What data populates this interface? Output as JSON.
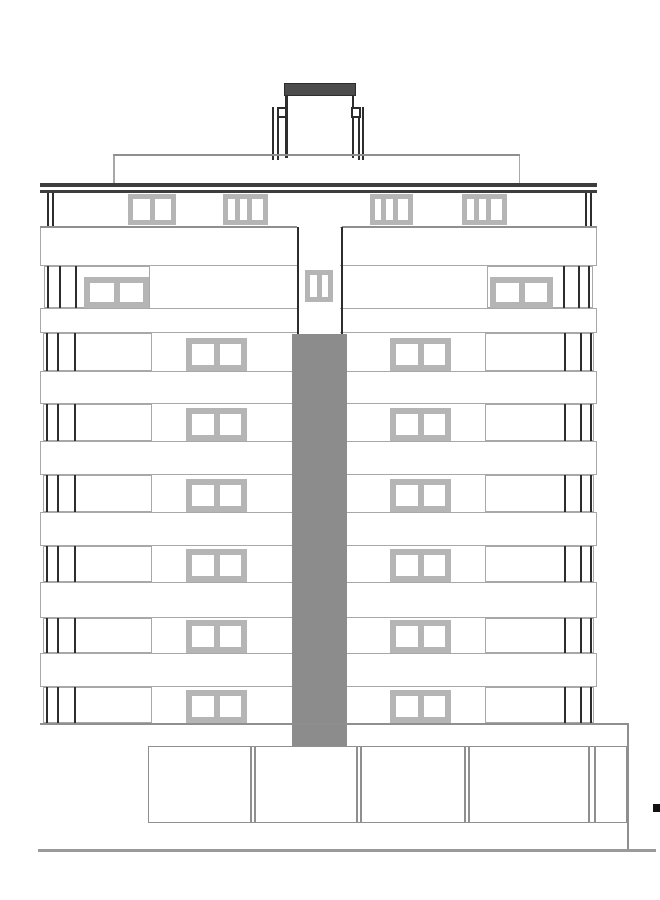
{
  "canvas": {
    "width": 660,
    "height": 900,
    "background": "#ffffff"
  },
  "colors": {
    "white": "#ffffff",
    "black": "#111111",
    "dark": "#2d2d2d",
    "parapet": "#3d3d3d",
    "cap": "#4c4c4c",
    "core": "#8c8c8c",
    "frame": "#b5b5b5",
    "light": "#a8a8a8",
    "mid": "#8f8f8f",
    "ground": "#9a9a9a"
  },
  "rooftop": {
    "items": [
      {
        "type": "rect",
        "name": "stair-tower-cap",
        "x": 284,
        "y": 83,
        "w": 72,
        "h": 13,
        "color": "cap",
        "border": "dark"
      },
      {
        "type": "line",
        "name": "stair-tower-wall-left",
        "x": 285,
        "y": 96,
        "w": 2.5,
        "h": 62,
        "color": "dark"
      },
      {
        "type": "line",
        "name": "stair-tower-wall-right",
        "x": 351.5,
        "y": 96,
        "w": 2.5,
        "h": 62,
        "color": "dark"
      },
      {
        "type": "line",
        "name": "roof-post",
        "x": 272,
        "y": 107,
        "w": 2,
        "h": 53,
        "color": "dark"
      },
      {
        "type": "line",
        "name": "roof-post",
        "x": 276.5,
        "y": 107,
        "w": 2,
        "h": 53,
        "color": "dark"
      },
      {
        "type": "line",
        "name": "roof-post",
        "x": 357.5,
        "y": 107,
        "w": 2,
        "h": 53,
        "color": "dark"
      },
      {
        "type": "line",
        "name": "roof-post",
        "x": 362,
        "y": 107,
        "w": 2,
        "h": 53,
        "color": "dark"
      },
      {
        "type": "box",
        "name": "roof-bracket-left",
        "x": 277,
        "y": 107,
        "w": 10,
        "h": 11,
        "border": "dark",
        "bw": 2
      },
      {
        "type": "box",
        "name": "roof-bracket-right",
        "x": 351,
        "y": 107,
        "w": 10,
        "h": 11,
        "border": "dark",
        "bw": 2
      }
    ]
  },
  "deck": {
    "items": [
      {
        "type": "line",
        "name": "penthouse-roof-line",
        "x": 113,
        "y": 154,
        "w": 407,
        "h": 2,
        "color": "mid"
      },
      {
        "type": "line",
        "name": "penthouse-wall-left",
        "x": 113,
        "y": 156,
        "w": 1.5,
        "h": 27.5,
        "color": "light"
      },
      {
        "type": "line",
        "name": "penthouse-wall-right",
        "x": 518.5,
        "y": 156,
        "w": 1.5,
        "h": 27.5,
        "color": "light"
      }
    ]
  },
  "parapet": {
    "items": [
      {
        "type": "line",
        "name": "parapet-bar-upper",
        "x": 40,
        "y": 183,
        "w": 557,
        "h": 3.5,
        "color": "parapet"
      },
      {
        "type": "line",
        "name": "parapet-bar-lower",
        "x": 40,
        "y": 189.5,
        "w": 557,
        "h": 3.5,
        "color": "parapet"
      }
    ]
  },
  "bands": {
    "x": 40,
    "w": 557,
    "rows": [
      {
        "y": 226.5,
        "h": 39.5
      },
      {
        "y": 308,
        "h": 25
      },
      {
        "y": 371,
        "h": 33
      },
      {
        "y": 441,
        "h": 34
      },
      {
        "y": 512,
        "h": 34
      },
      {
        "y": 582,
        "h": 36
      },
      {
        "y": 653,
        "h": 34
      }
    ]
  },
  "floors": {
    "layout": {
      "regular": {
        "boxes": [
          {
            "x": 43,
            "w": 109
          },
          {
            "x": 485,
            "w": 109
          }
        ],
        "mullions": [
          46,
          57,
          74,
          564,
          580,
          590
        ],
        "windows": [
          {
            "x": 186,
            "w": 61,
            "h": 33,
            "frame": 6,
            "panes": [
              1,
              1
            ]
          },
          {
            "x": 390,
            "w": 61,
            "h": 33,
            "frame": 6,
            "panes": [
              1,
              1
            ]
          }
        ]
      },
      "special": {
        "boxes": [
          {
            "x": 44,
            "w": 106
          },
          {
            "x": 487,
            "w": 106
          }
        ],
        "mullions": [
          47,
          59,
          75,
          563,
          578,
          588
        ],
        "windows": [
          {
            "x": 84,
            "w": 65,
            "h": 31,
            "frame": 6,
            "panes": [
              1,
              1
            ]
          },
          {
            "x": 490,
            "w": 63,
            "h": 31,
            "frame": 6,
            "panes": [
              1,
              1
            ]
          }
        ]
      }
    },
    "rows": [
      {
        "name": "floor-8",
        "kind": "special",
        "y": 266,
        "h": 42
      },
      {
        "name": "floor-7",
        "kind": "regular",
        "y": 333,
        "h": 38
      },
      {
        "name": "floor-6",
        "kind": "regular",
        "y": 404,
        "h": 37
      },
      {
        "name": "floor-5",
        "kind": "regular",
        "y": 475,
        "h": 37
      },
      {
        "name": "floor-4",
        "kind": "regular",
        "y": 546,
        "h": 36
      },
      {
        "name": "floor-3",
        "kind": "regular",
        "y": 618,
        "h": 35
      },
      {
        "name": "floor-2",
        "kind": "regular",
        "y": 687,
        "h": 36
      }
    ]
  },
  "attic": {
    "items": [
      {
        "type": "line",
        "name": "attic-edge-line",
        "x": 47,
        "y": 193,
        "w": 2,
        "h": 33.5,
        "color": "dark"
      },
      {
        "type": "line",
        "name": "attic-edge-line",
        "x": 52,
        "y": 193,
        "w": 2,
        "h": 33.5,
        "color": "dark"
      },
      {
        "type": "line",
        "name": "attic-edge-line",
        "x": 585,
        "y": 193,
        "w": 2,
        "h": 33.5,
        "color": "dark"
      },
      {
        "type": "line",
        "name": "attic-edge-line",
        "x": 590,
        "y": 193,
        "w": 2,
        "h": 33.5,
        "color": "dark"
      },
      {
        "type": "window",
        "name": "attic-window",
        "x": 128,
        "y": 194,
        "w": 48,
        "h": 31,
        "frame": 5,
        "panes": [
          1,
          1
        ]
      },
      {
        "type": "window",
        "name": "attic-window",
        "x": 223,
        "y": 194,
        "w": 45,
        "h": 31,
        "frame": 5,
        "panes": [
          0.28,
          0.28,
          0.44
        ]
      },
      {
        "type": "window",
        "name": "attic-window",
        "x": 370,
        "y": 194,
        "w": 43,
        "h": 31,
        "frame": 5,
        "panes": [
          0.28,
          0.28,
          0.44
        ]
      },
      {
        "type": "window",
        "name": "attic-window",
        "x": 462,
        "y": 194,
        "w": 45,
        "h": 31,
        "frame": 5,
        "panes": [
          0.28,
          0.28,
          0.44
        ]
      },
      {
        "type": "line",
        "name": "attic-base-line-left",
        "x": 40,
        "y": 226,
        "w": 257,
        "h": 1.5,
        "color": "mid"
      },
      {
        "type": "line",
        "name": "attic-base-line-right",
        "x": 342,
        "y": 226,
        "w": 255,
        "h": 1.5,
        "color": "mid"
      }
    ]
  },
  "recess": {
    "items": [
      {
        "type": "rect",
        "name": "recess-surface",
        "x": 299,
        "y": 226.5,
        "w": 41,
        "h": 108,
        "color": "white"
      },
      {
        "type": "line",
        "name": "recess-wall-left",
        "x": 297,
        "y": 226.5,
        "w": 2,
        "h": 108,
        "color": "dark"
      },
      {
        "type": "line",
        "name": "recess-wall-right",
        "x": 340.5,
        "y": 226.5,
        "w": 2,
        "h": 108,
        "color": "dark"
      },
      {
        "type": "window",
        "name": "recess-window",
        "x": 305,
        "y": 270,
        "w": 28,
        "h": 32,
        "frame": 5,
        "panes": [
          1,
          1
        ]
      }
    ]
  },
  "core": {
    "items": [
      {
        "type": "rect",
        "name": "core-column",
        "x": 292,
        "y": 334,
        "w": 55,
        "h": 414,
        "color": "core"
      }
    ]
  },
  "base": {
    "items": [
      {
        "type": "line",
        "name": "facade-base-line",
        "x": 40,
        "y": 723,
        "w": 589,
        "h": 2,
        "color": "mid"
      },
      {
        "type": "box",
        "name": "podium",
        "x": 148,
        "y": 746,
        "w": 479,
        "h": 77,
        "border": "mid"
      },
      {
        "type": "line",
        "name": "podium-divider",
        "x": 250,
        "y": 746,
        "w": 1.5,
        "h": 77,
        "color": "mid"
      },
      {
        "type": "line",
        "name": "podium-divider",
        "x": 254,
        "y": 746,
        "w": 1.5,
        "h": 77,
        "color": "mid"
      },
      {
        "type": "line",
        "name": "podium-divider",
        "x": 356,
        "y": 746,
        "w": 1.5,
        "h": 77,
        "color": "mid"
      },
      {
        "type": "line",
        "name": "podium-divider",
        "x": 360,
        "y": 746,
        "w": 1.5,
        "h": 77,
        "color": "mid"
      },
      {
        "type": "line",
        "name": "podium-divider",
        "x": 464,
        "y": 746,
        "w": 1.5,
        "h": 77,
        "color": "mid"
      },
      {
        "type": "line",
        "name": "podium-divider",
        "x": 468,
        "y": 746,
        "w": 1.5,
        "h": 77,
        "color": "mid"
      },
      {
        "type": "line",
        "name": "podium-divider",
        "x": 588,
        "y": 746,
        "w": 1.5,
        "h": 77,
        "color": "mid"
      },
      {
        "type": "line",
        "name": "podium-divider",
        "x": 594,
        "y": 746,
        "w": 1.5,
        "h": 77,
        "color": "mid"
      },
      {
        "type": "line",
        "name": "podium-right-edge",
        "x": 627,
        "y": 723,
        "w": 2,
        "h": 128,
        "color": "mid"
      }
    ]
  },
  "ground": {
    "items": [
      {
        "type": "line",
        "name": "ground-line",
        "x": 38,
        "y": 849,
        "w": 618,
        "h": 3,
        "color": "ground"
      },
      {
        "type": "rect",
        "name": "site-marker",
        "x": 653,
        "y": 804,
        "w": 7,
        "h": 8,
        "color": "black"
      }
    ]
  }
}
